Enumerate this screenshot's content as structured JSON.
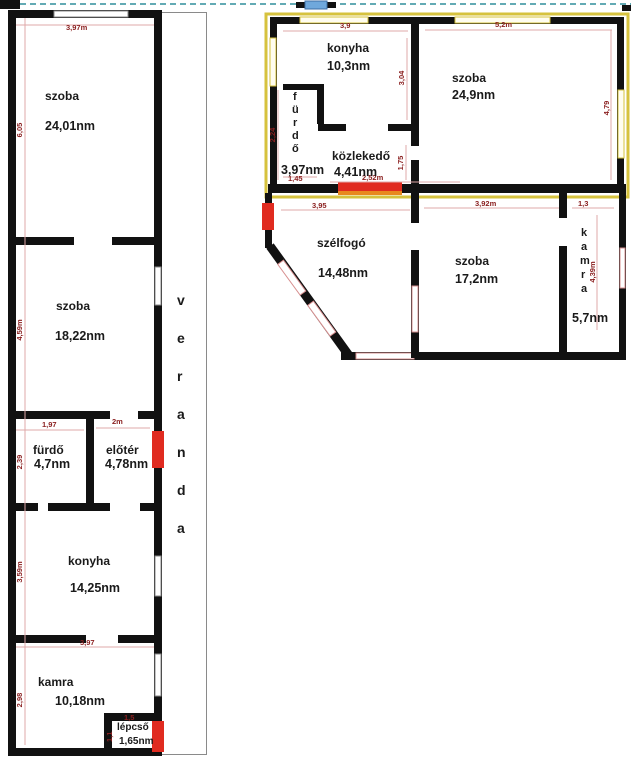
{
  "colors": {
    "wall": "#111111",
    "door": "#e02b20",
    "door_accent": "#e8881e",
    "window_pink": "#d89090",
    "win_stroke": "#8a8a8a",
    "dim_line": "#dfa8a8",
    "dim_text": "#8b2020",
    "yellow": "#d6c23e",
    "marker_blue": "#6fa8dc",
    "dash": "#63aab4",
    "veranda_border": "#8a8a8a"
  },
  "plan_left": {
    "rooms": {
      "szoba1": {
        "name": "szoba",
        "area": "24,01nm"
      },
      "szoba2": {
        "name": "szoba",
        "area": "18,22nm"
      },
      "furdo": {
        "name": "fürdő",
        "area": "4,7nm"
      },
      "eloter": {
        "name": "előtér",
        "area": "4,78nm"
      },
      "konyha": {
        "name": "konyha",
        "area": "14,25nm"
      },
      "kamra": {
        "name": "kamra",
        "area": "10,18nm"
      },
      "lepcso": {
        "name": "lépcső",
        "area": "1,65nm"
      }
    },
    "veranda": {
      "letters": [
        "v",
        "e",
        "r",
        "a",
        "n",
        "d",
        "a"
      ]
    },
    "dims": {
      "top_w": "3,97m",
      "szoba1_h": "6,05",
      "szoba2_h": "4,59m",
      "furdo_w": "1,97",
      "eloter_w": "2m",
      "furdo_h": "2,39",
      "konyha_h": "3,59m",
      "kamra_w": "3,97",
      "kamra_h": "2,98",
      "lepcso_w": "1,5",
      "lepcso_h": "1,1"
    }
  },
  "plan_upper": {
    "rooms": {
      "konyha": {
        "name": "konyha",
        "area": "10,3nm"
      },
      "szoba": {
        "name": "szoba",
        "area": "24,9nm"
      },
      "furdo": {
        "letters": [
          "f",
          "ü",
          "r",
          "d",
          "ő"
        ],
        "area": "3,97nm"
      },
      "kozlekedo": {
        "name": "közlekedő",
        "area": "4,41nm"
      }
    },
    "dims": {
      "konyha_w": "3,9",
      "szoba_w": "5,2m",
      "konyha_h": "3,04",
      "szoba_h": "4,79",
      "furdo_h": "2,24",
      "furdo_w": "1,45",
      "kozlekedo_w": "2,52m",
      "kozlekedo_h": "1,75"
    }
  },
  "plan_lower": {
    "rooms": {
      "szelfogo": {
        "name": "szélfogó",
        "area": "14,48nm"
      },
      "szoba": {
        "name": "szoba",
        "area": "17,2nm"
      },
      "kamra": {
        "letters": [
          "k",
          "a",
          "m",
          "r",
          "a"
        ],
        "area": "5,7nm"
      }
    },
    "dims": {
      "szelfogo_w": "3,95",
      "szoba_w": "3,92m",
      "kamra_w": "1,3",
      "kamra_h": "4,39m"
    }
  }
}
